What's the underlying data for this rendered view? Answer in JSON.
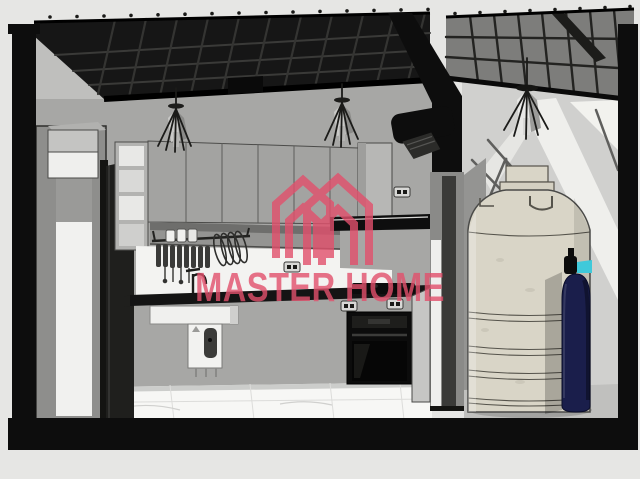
{
  "watermark": {
    "brand": "MASTER HOME",
    "color": "#e2506c",
    "logo_icon": "double-house-m-icon"
  },
  "scene": {
    "rooms": [
      {
        "name": "kitchen",
        "objects": [
          "metal-roof-structure",
          "pendant-light",
          "pendant-light",
          "upper-cabinets",
          "open-shelf-unit",
          "tall-cabinet",
          "open-door-panel",
          "dish-rack",
          "faucet",
          "sink-counter",
          "water-heater",
          "range-hood",
          "cooktop",
          "built-in-oven",
          "power-outlet",
          "power-outlet",
          "power-outlet",
          "power-outlet",
          "air-conditioner",
          "tile-floor"
        ]
      },
      {
        "name": "utility-room",
        "objects": [
          "translucent-roof-panels",
          "pendant-light",
          "daylight-shadows",
          "water-tank",
          "gas-cylinder",
          "gas-valve",
          "concrete-floor",
          "open-door"
        ]
      }
    ],
    "colors": {
      "background": "#e6e6e4",
      "section_black": "#0d0d0d",
      "roof_dark": "#161616",
      "roof_panel": "#7d7d7b",
      "kitchen_wall": "#a7a7a5",
      "utility_wall": "#d0d0ce",
      "cabinet_gray": "#a3a3a1",
      "backsplash_white": "#f3f3f1",
      "countertop_black": "#141414",
      "floor_tile_white": "#f7f7f5",
      "utility_floor_gray": "#c0c0be",
      "water_tank": "#d9d5c7",
      "gas_cylinder": "#1a1e4b",
      "gas_valve": "#3fc9da",
      "appliance_black": "#0c0c0c"
    }
  }
}
